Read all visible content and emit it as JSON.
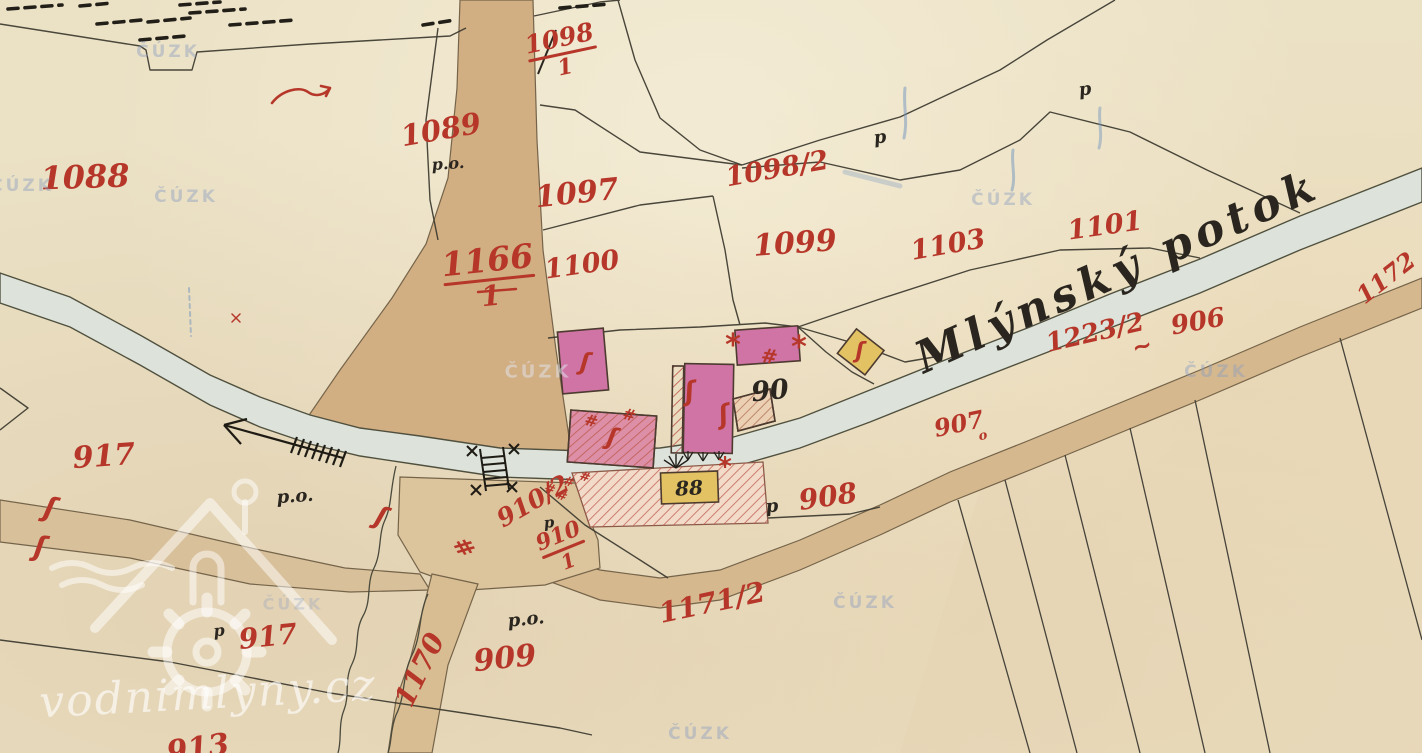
{
  "map": {
    "stream_label": "Mlýnský potok",
    "parcels": {
      "p1088": "1088",
      "p1089": "1089",
      "p1097": "1097",
      "p1098_1_num": "1098",
      "p1098_1_den": "1",
      "p1098_2": "1098/2",
      "p1099": "1099",
      "p1100": "1100",
      "p1103": "1103",
      "p1101": "1101",
      "p1166_num": "1166",
      "p1166_den": "1",
      "p1223_2": "1223/2",
      "p906": "906",
      "p1172": "1172",
      "p907": "907",
      "p907_suffix": "o",
      "p908": "908",
      "p909": "909",
      "p910_2": "910/2",
      "p910_1_num": "910",
      "p910_1_den": "1",
      "p917_a": "917",
      "p917_b": "917",
      "p913": "913",
      "p1170": "1170",
      "p1171_2": "1171/2"
    },
    "house_numbers": {
      "h88": "88",
      "h90": "90"
    },
    "abbreviations": {
      "po": "p.o.",
      "p": "p"
    },
    "marks": {
      "squiggle": "ʃ",
      "hash": "#",
      "asterisk": "*",
      "tilde": "~"
    },
    "watermarks": {
      "cuzk": "ČÚZK",
      "site": "vodnimlyny.cz"
    },
    "colors": {
      "red_ink": "#b6372a",
      "black_ink": "#2a261f",
      "paper": "#ebe1c5",
      "road": "#d2ae83",
      "stream": "#dde3da",
      "masonry_building": "#cf74a4",
      "wooden_building": "#e2c263",
      "watermark_blue": "#8c9cc0"
    }
  }
}
